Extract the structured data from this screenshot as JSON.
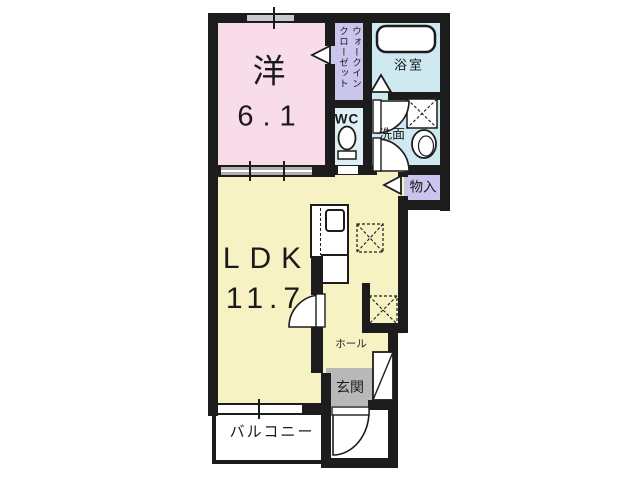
{
  "floor_plan": {
    "rooms": {
      "western_room": {
        "label": "洋",
        "size": "6.1"
      },
      "walk_in_closet": {
        "label_line1": "ウォークイン",
        "label_line2": "クローゼット"
      },
      "bathroom": {
        "label": "浴室"
      },
      "toilet": {
        "label": "WC"
      },
      "washroom": {
        "label": "洗面"
      },
      "storage": {
        "label": "物入"
      },
      "ldk": {
        "label": "LDK",
        "size": "11.7"
      },
      "hall": {
        "label": "ホール"
      },
      "entrance": {
        "label": "玄関"
      },
      "balcony": {
        "label": "バルコニー"
      }
    },
    "colors": {
      "western_room": "#f8dce9",
      "ldk": "#f7f2c3",
      "closet_and_storage": "#c9c5ec",
      "bath_and_washroom": "#cfe9f1",
      "toilet": "#dff0f4",
      "entrance": "#b8b8b8",
      "wall": "#1c1c1c"
    }
  }
}
